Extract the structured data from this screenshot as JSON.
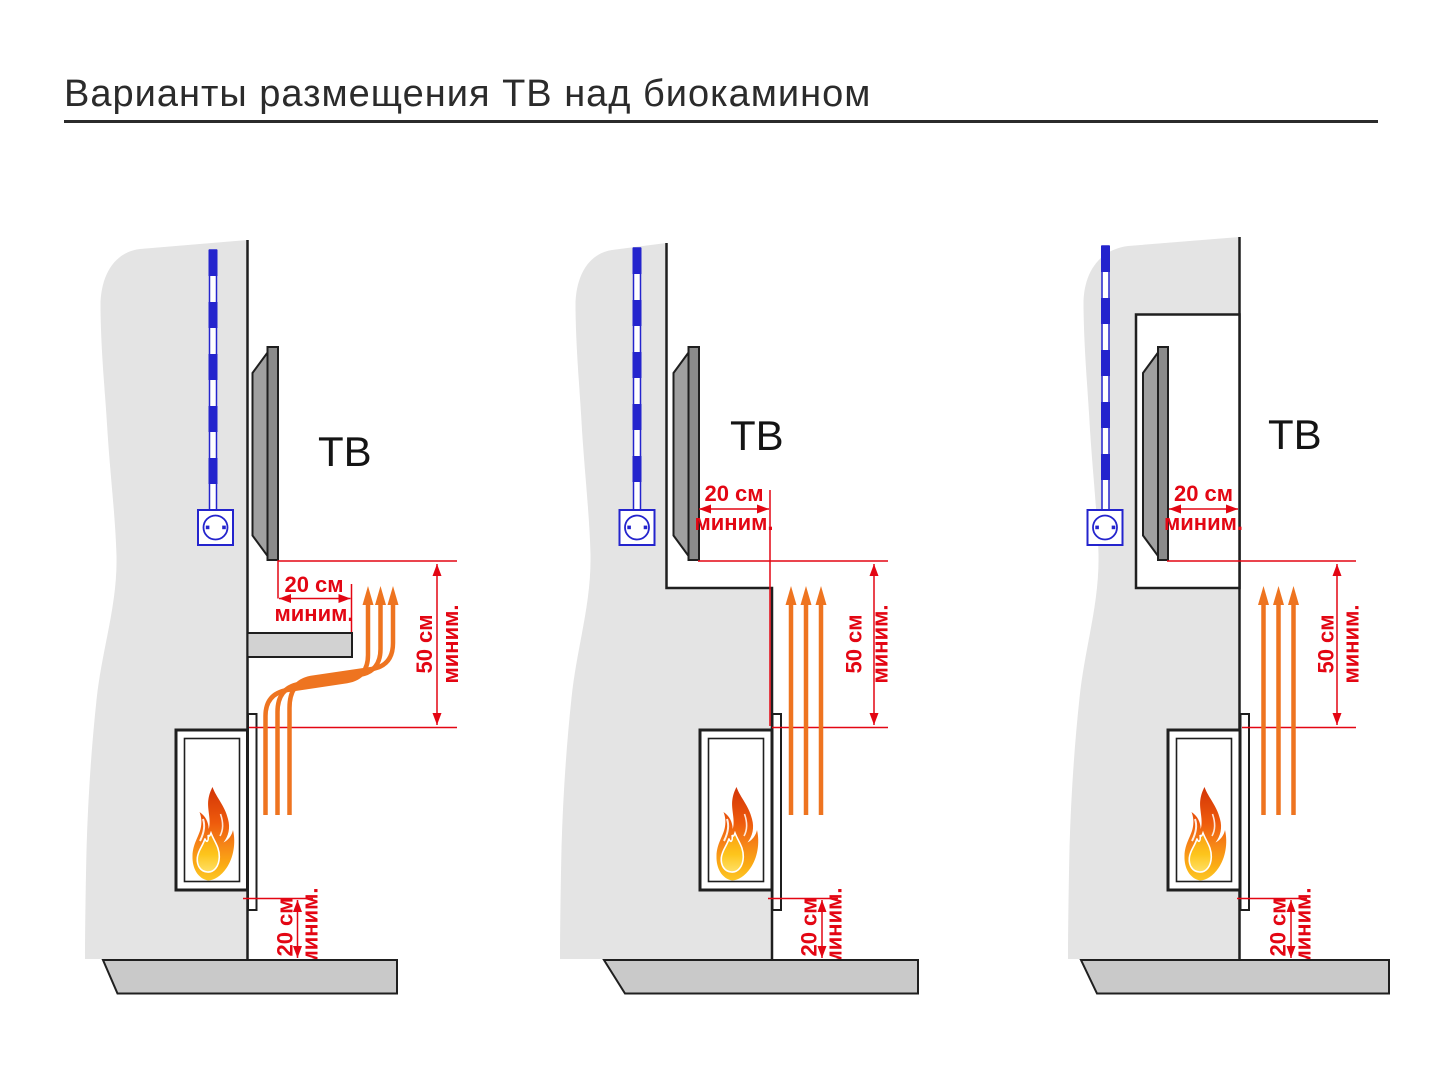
{
  "title": "Варианты размещения ТВ над биокамином",
  "colors": {
    "dimension_red": "#e30613",
    "heat_orange": "#ee7420",
    "cable_blue": "#2424cd",
    "wall_gray": "#e4e4e4",
    "floor_gray": "#c9c9c9",
    "tv_gray": "#8a8a8a",
    "line_black": "#1f1f1f"
  },
  "diagrams": [
    {
      "id": "tv-above-mantel-shelf",
      "tv_label": "ТВ",
      "side_clearance": {
        "value": "20 см",
        "qualifier": "миним."
      },
      "above_clearance": {
        "value": "50 см",
        "qualifier": "миним."
      },
      "floor_clearance": {
        "value": "20 см",
        "qualifier": "миним."
      }
    },
    {
      "id": "tv-recessed-behind-fireplace-plane",
      "tv_label": "ТВ",
      "side_clearance": {
        "value": "20 см",
        "qualifier": "миним."
      },
      "above_clearance": {
        "value": "50 см",
        "qualifier": "миним."
      },
      "floor_clearance": {
        "value": "20 см",
        "qualifier": "миним."
      }
    },
    {
      "id": "tv-in-wall-niche",
      "tv_label": "ТВ",
      "side_clearance": {
        "value": "20 см",
        "qualifier": "миним."
      },
      "above_clearance": {
        "value": "50 см",
        "qualifier": "миним."
      },
      "floor_clearance": {
        "value": "20 см",
        "qualifier": "миним."
      }
    }
  ]
}
